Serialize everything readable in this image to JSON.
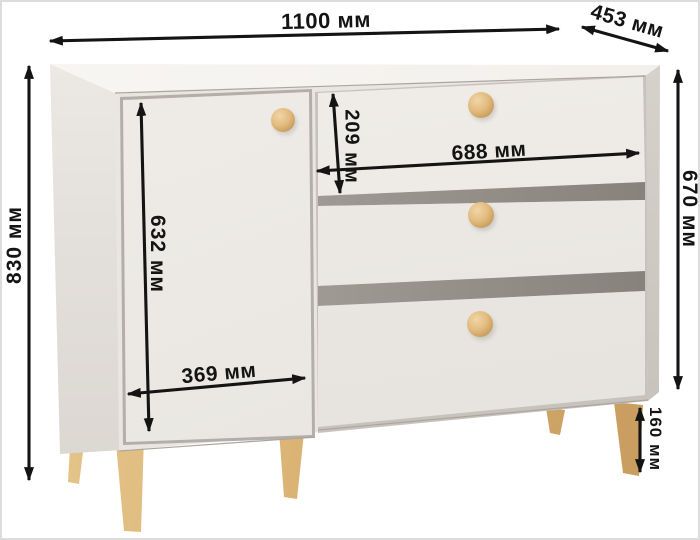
{
  "dimensions": {
    "overall_width": {
      "value": 1100,
      "unit": "мм",
      "label": "1100 мм"
    },
    "overall_depth": {
      "value": 453,
      "unit": "мм",
      "label": "453 мм"
    },
    "overall_height": {
      "value": 830,
      "unit": "мм",
      "label": "830 мм"
    },
    "body_height": {
      "value": 670,
      "unit": "мм",
      "label": "670 мм"
    },
    "door_height": {
      "value": 632,
      "unit": "мм",
      "label": "632 мм"
    },
    "door_width": {
      "value": 369,
      "unit": "мм",
      "label": "369 мм"
    },
    "drawer_height": {
      "value": 209,
      "unit": "мм",
      "label": "209 мм"
    },
    "drawer_width": {
      "value": 688,
      "unit": "мм",
      "label": "688 мм"
    },
    "leg_height": {
      "value": 160,
      "unit": "мм",
      "label": "160 мм"
    }
  },
  "colors": {
    "background": "#ffffff",
    "body": "#e9e6e1",
    "wood_accent": "#dcb475",
    "arrow": "#141414"
  }
}
